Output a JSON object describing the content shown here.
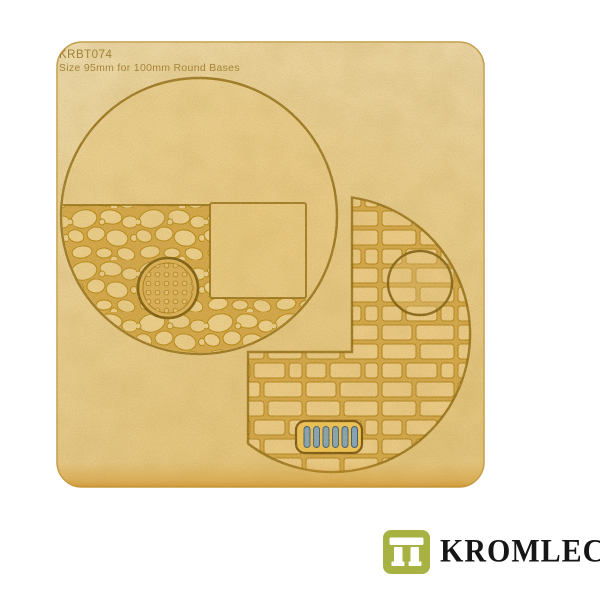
{
  "product": {
    "code": "KRBT074",
    "size_label": "Size 95mm for 100mm Round Bases"
  },
  "brand": {
    "name": "KROMLECH"
  },
  "colors": {
    "background": "#ffffff",
    "board": "#e9d3a2",
    "board_warm": "#e7c67b",
    "engraving": "#8e680e",
    "mortar": "#d2a445",
    "stone": "#ebcd89",
    "drain_bar": "#7fa1b9",
    "drain_frame": "#eec253",
    "logo_green": "#a7b243",
    "logo_text": "#161616"
  }
}
